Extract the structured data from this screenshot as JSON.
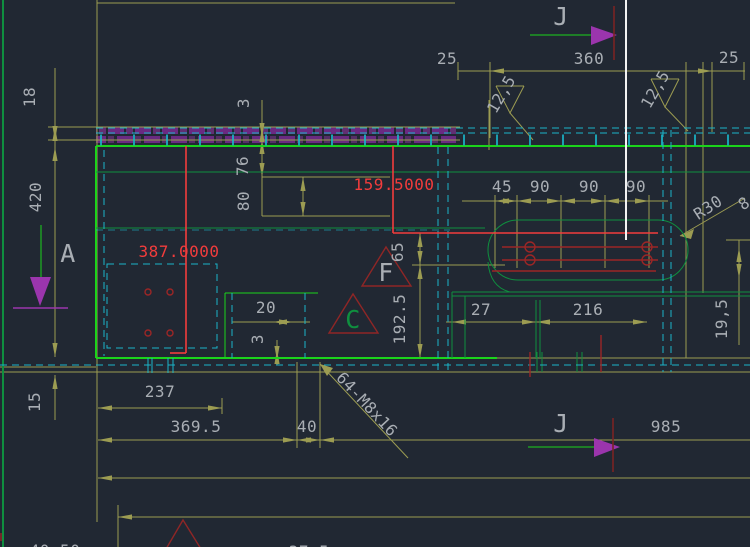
{
  "palette": {
    "bg": "#212833",
    "olive": "#9c9c52",
    "txt": "#a9aeb4",
    "grb": "#1bd41b",
    "grd": "#0f8f3f",
    "cyan": "#1ab4c8",
    "red": "#f23c3c",
    "redd": "#9c2626",
    "maroon": "#7a2424",
    "magenta": "#9b35ad",
    "purple": "#6e2a86",
    "white": "#f2f2f2"
  },
  "labels": {
    "marker_j_top": "J",
    "marker_j_bottom": "J",
    "marker_a": "A",
    "detail_f": "F",
    "detail_c": "C",
    "top_25_left": "25",
    "top_360": "360",
    "top_25_right": "25",
    "rough_left": "12,5",
    "rough_right": "12,5",
    "left_18": "18",
    "left_420": "420",
    "left_15": "15",
    "mid_3_top": "3",
    "mid_76": "76",
    "mid_80": "80",
    "red_387": "387.0000",
    "red_159": "159.5000",
    "chain_45": "45",
    "chain_90a": "90",
    "chain_90b": "90",
    "chain_90c": "90",
    "r30": "R30",
    "edge_glyph": "8",
    "right_19_5": "19,5",
    "mid_65": "65",
    "mid_192_5": "192.5",
    "pocket_20": "20",
    "pocket_3": "3",
    "pocket_27": "27",
    "pocket_216": "216",
    "bottom_237": "237",
    "bottom_369_5": "369.5",
    "bottom_40": "40",
    "bottom_985": "985",
    "thread_note": "64-M8x16",
    "bottom_40_50": "40.50",
    "bottom_37_5": "37.5"
  }
}
